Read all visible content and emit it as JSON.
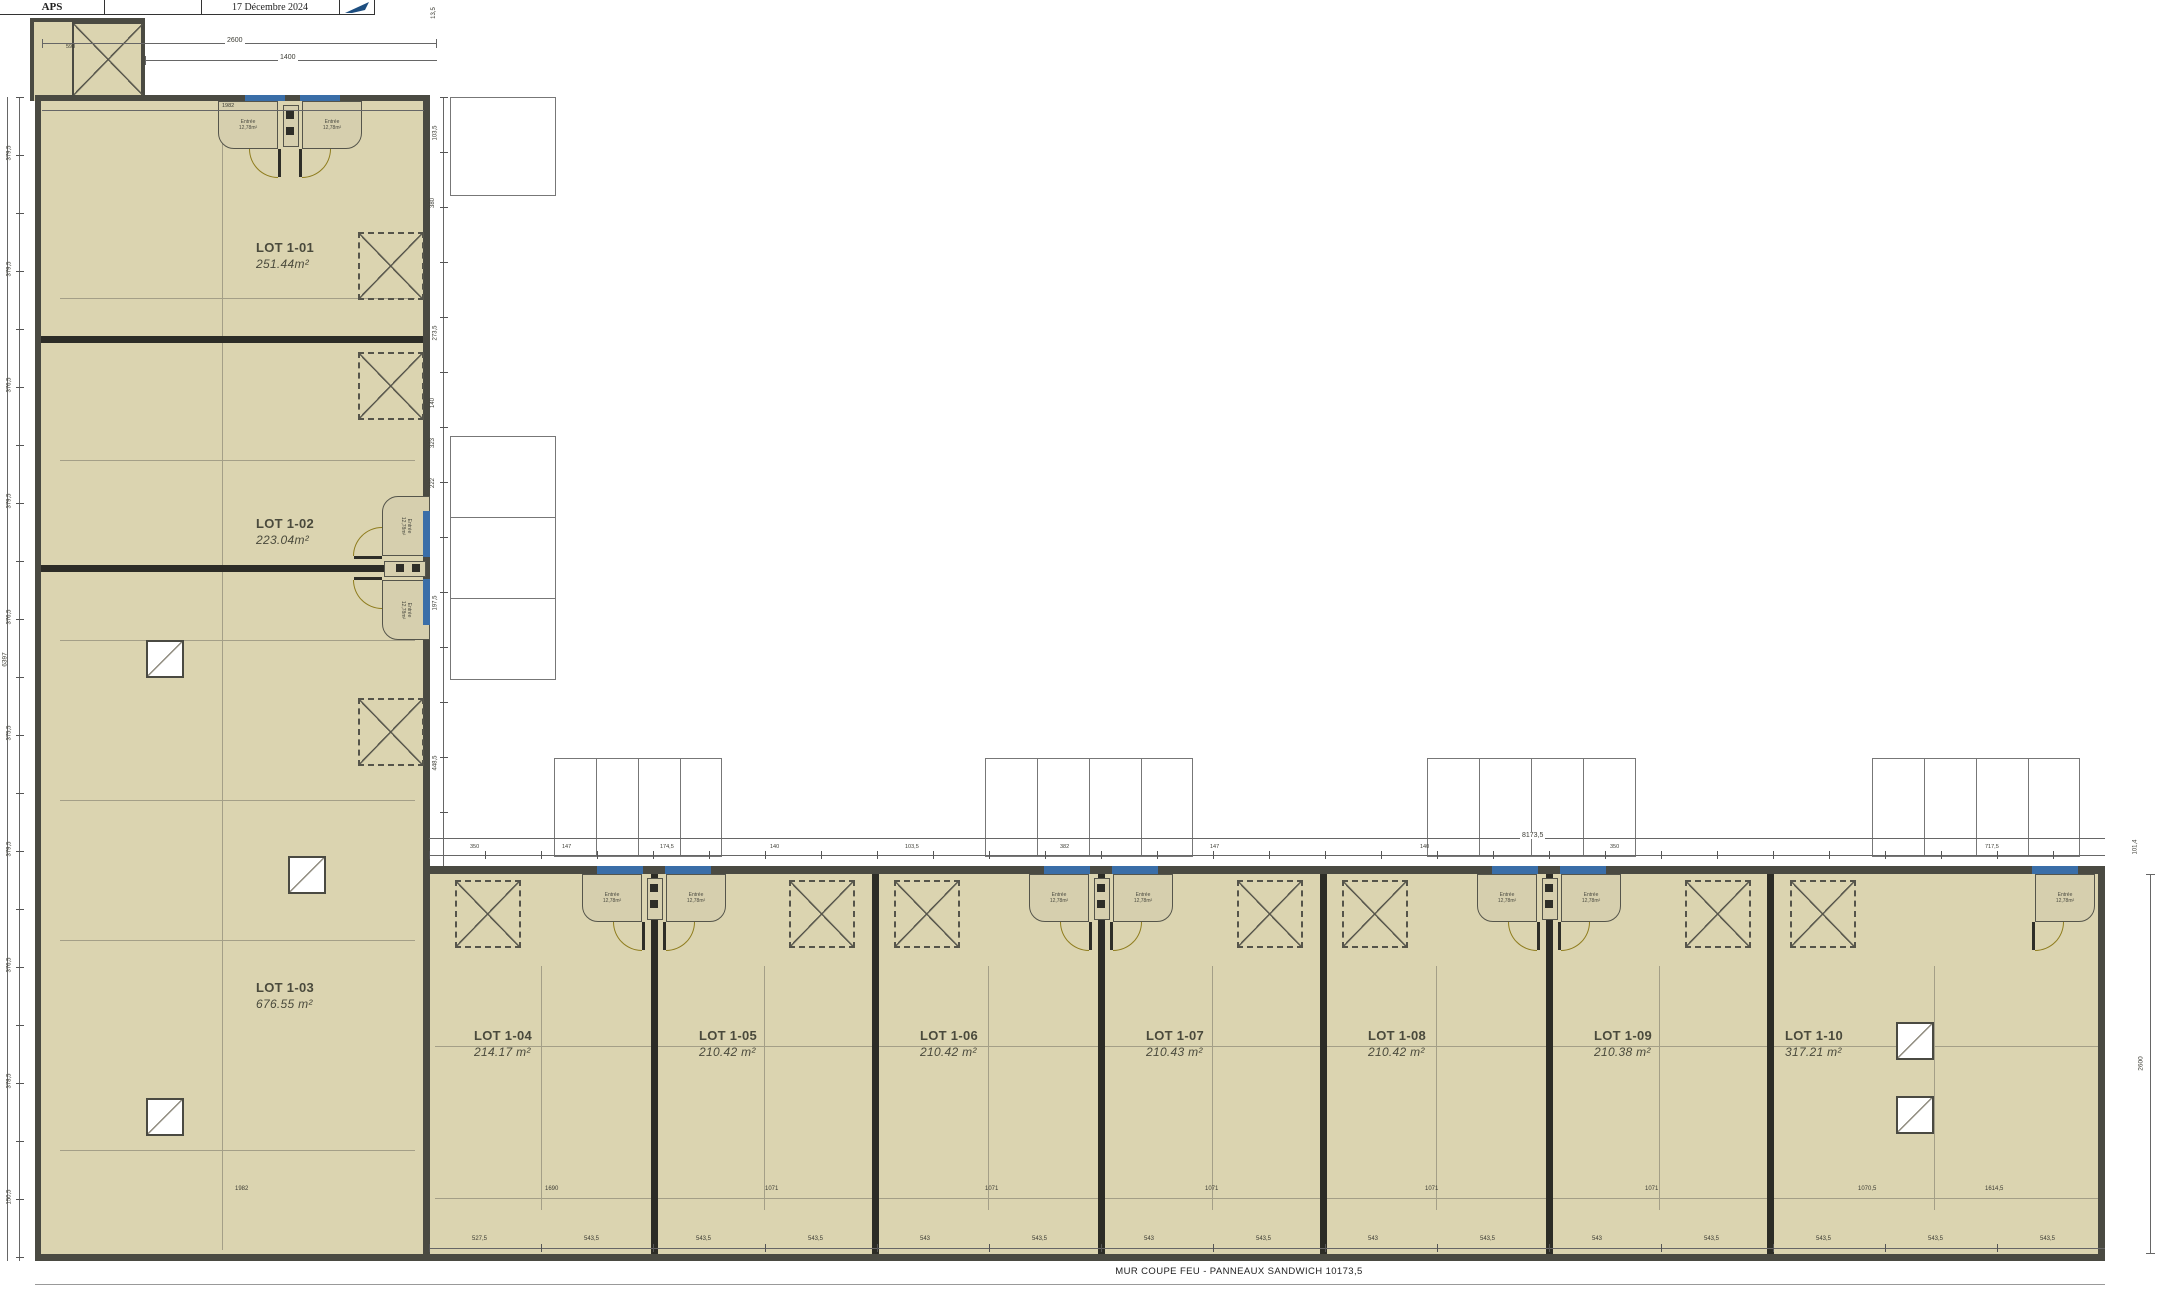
{
  "title_block": {
    "phase": "APS",
    "date": "17 Décembre 2024"
  },
  "note_bottom": "MUR COUPE FEU - PANNEAUX SANDWICH 10173,5",
  "lots": [
    {
      "id": "LOT 1-01",
      "area": "251.44m²"
    },
    {
      "id": "LOT 1-02",
      "area": "223.04m²"
    },
    {
      "id": "LOT 1-03",
      "area": "676.55 m²"
    },
    {
      "id": "LOT 1-04",
      "area": "214.17 m²"
    },
    {
      "id": "LOT 1-05",
      "area": "210.42 m²"
    },
    {
      "id": "LOT 1-06",
      "area": "210.42 m²"
    },
    {
      "id": "LOT 1-07",
      "area": "210.43 m²"
    },
    {
      "id": "LOT 1-08",
      "area": "210.42 m²"
    },
    {
      "id": "LOT 1-09",
      "area": "210.38 m²"
    },
    {
      "id": "LOT 1-10",
      "area": "317.21 m²"
    }
  ],
  "vestibule": {
    "room": "Entrée",
    "room_area": "12,78m²"
  },
  "dims": {
    "top": {
      "overall": "2600",
      "inner": "1400",
      "porch": "598",
      "wing_width": "1982",
      "corner": "13,5"
    },
    "left": {
      "total": "6397",
      "segments": [
        "379,5",
        "379,5",
        "376,5",
        "379,5",
        "376,5",
        "375,5",
        "379,5",
        "376,5",
        "378,5",
        "150,5"
      ]
    },
    "wing_right_chain": [
      "103,5",
      "380",
      "273,5",
      "140",
      "323",
      "222",
      "197,5",
      "448,5"
    ],
    "row_top": {
      "total": "8173,5",
      "chain": [
        "350",
        "147",
        "174,5",
        "140",
        "103,5",
        "382",
        "147",
        "140",
        "350",
        "717,5"
      ],
      "corner": "101,4"
    },
    "right": {
      "total": "2600"
    },
    "row_inner": [
      "1690",
      "1071",
      "1071",
      "1071",
      "1071",
      "1071",
      "1070,5",
      "1614,5"
    ],
    "row_bottom_chain": [
      "527,5",
      "543,5",
      "543,5",
      "543,5",
      "543",
      "543,5",
      "543",
      "543,5",
      "543",
      "543,5",
      "543",
      "543,5",
      "543,5",
      "543,5",
      "543,5"
    ],
    "wing_bottom": "1982"
  },
  "colors": {
    "floor": "#dbd4b0",
    "outer_wall": "#4a4a42",
    "unit_wall": "#2c2c26",
    "door_arc": "#8f7d1e",
    "glazing": "#3a6ea8",
    "north_blue": "#1d4e80"
  }
}
